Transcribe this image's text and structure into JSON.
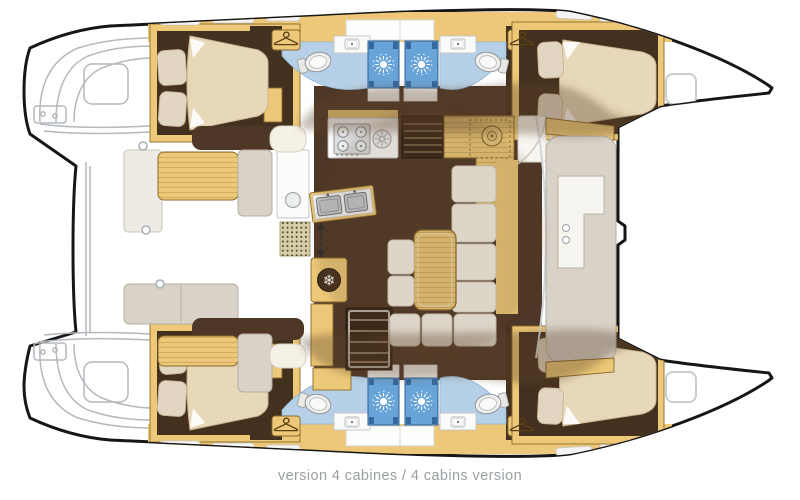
{
  "caption": {
    "text": "version 4 cabines / 4 cabins version"
  },
  "glyphs": {
    "snowflake": "❄"
  },
  "palette": {
    "background": "#ffffff",
    "hull_outline": "#161616",
    "structure_grey": "#b4b9bd",
    "wood": "#ecc878",
    "wood_edge": "#8a6a2c",
    "cabin_floor": "#43301f",
    "salon_floor": "#4e3726",
    "stair_dark": "#372617",
    "mattress": "#e8d8ba",
    "mattress_edge": "#c9b38f",
    "pillow": "#e2d5c2",
    "bath_floor": "#b6d1e7",
    "shower_blue": "#68a4d8",
    "shower_dark": "#2e5f95",
    "cushion": "#f5f1e7",
    "cushion_edge": "#d8d2c2",
    "bench_grey": "#d8d2c8",
    "bench_edge": "#b5afa2",
    "counter": "#fbfbf9",
    "counter_edge": "#c2c4c6",
    "steel": "#c3c9cd",
    "roof_shadow": "rgba(94,64,36,0.36)",
    "caption_grey": "#9aa0a3"
  },
  "icons": [
    {
      "name": "shower-sun-icon",
      "meaning": "shower starburst",
      "count": 4
    },
    {
      "name": "hanger-icon",
      "meaning": "wardrobe hanger",
      "count": 4
    },
    {
      "name": "snowflake-icon",
      "meaning": "refrigerator",
      "count": 1
    },
    {
      "name": "stove-icon",
      "meaning": "4-burner hob with round burner",
      "count": 1
    },
    {
      "name": "double-sink-icon",
      "meaning": "galley twin sink",
      "count": 1
    },
    {
      "name": "toilet-icon",
      "meaning": "marine toilet",
      "count": 4
    },
    {
      "name": "washbasin-icon",
      "meaning": "bathroom sink",
      "count": 4
    },
    {
      "name": "sliding-door-arrow-icon",
      "meaning": "sliding door direction",
      "count": 1
    },
    {
      "name": "deck-hatch-icon",
      "meaning": "bow deck hatch",
      "count": 2
    },
    {
      "name": "companionway-stairs",
      "meaning": "steps down to hull",
      "count": 2
    }
  ]
}
